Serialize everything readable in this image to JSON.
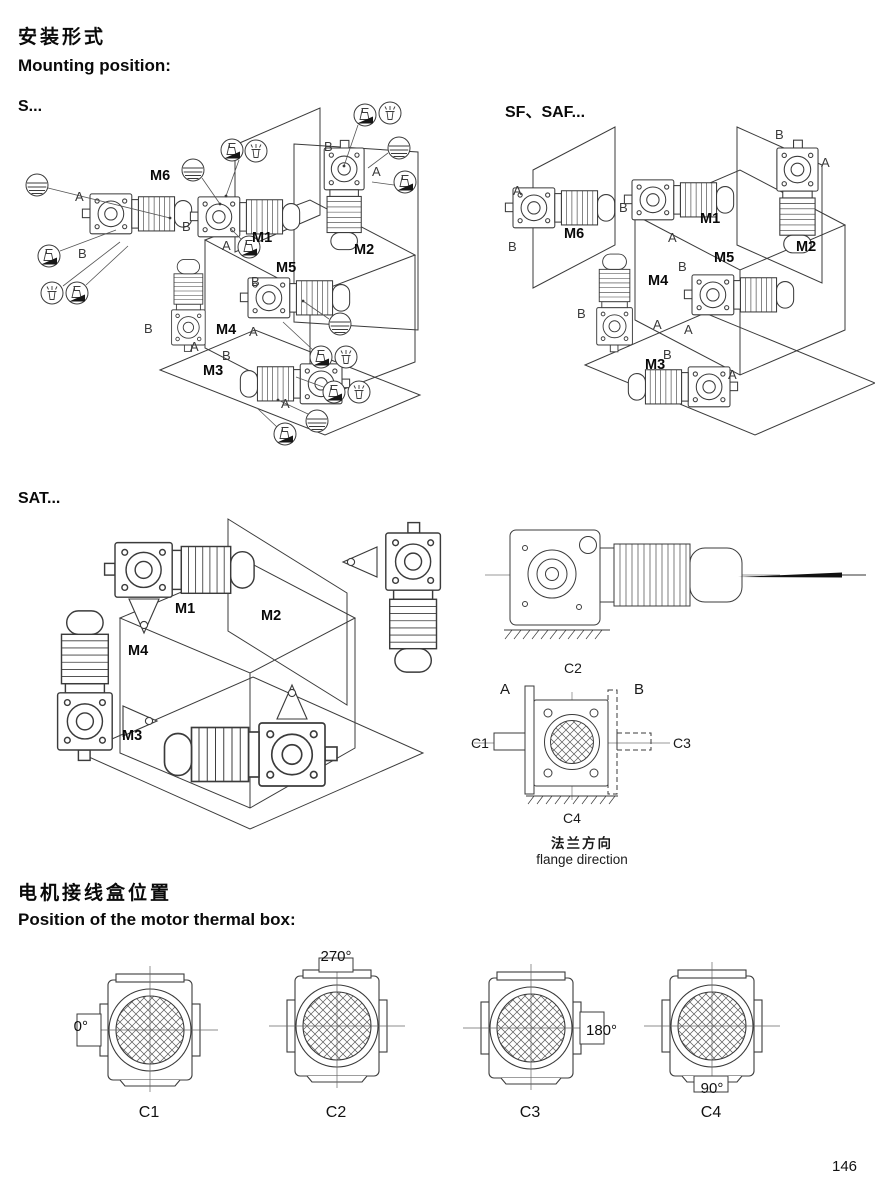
{
  "header": {
    "title_zh": "安装形式",
    "title_en": "Mounting position:"
  },
  "sections": {
    "s": "S...",
    "sf_saf": "SF、SAF...",
    "sat": "SAT..."
  },
  "labels": {
    "a": "A",
    "b": "B"
  },
  "mounting": {
    "m1": "M1",
    "m2": "M2",
    "m3": "M3",
    "m4": "M4",
    "m5": "M5",
    "m6": "M6"
  },
  "flange": {
    "c1": "C1",
    "c2": "C2",
    "c3": "C3",
    "c4": "C4",
    "caption_zh": "法兰方向",
    "caption_en": "flange direction"
  },
  "thermal_box": {
    "title_zh": "电机接线盒位置",
    "title_en": "Position of the motor thermal box:",
    "items": [
      {
        "label": "C1",
        "angle": "0°",
        "box_position": "left"
      },
      {
        "label": "C2",
        "angle": "270°",
        "box_position": "top"
      },
      {
        "label": "C3",
        "angle": "180°",
        "box_position": "right"
      },
      {
        "label": "C4",
        "angle": "90°",
        "box_position": "bottom"
      }
    ]
  },
  "icons": {
    "oil_level_plug": "circle-with-level-lines",
    "oil_drain_plug": "circle-with-black-wedge",
    "breather_plug": "circle-with-vent-plug",
    "view_direction": "left-pointing-arrow"
  },
  "footer": {
    "page_number": "146"
  }
}
